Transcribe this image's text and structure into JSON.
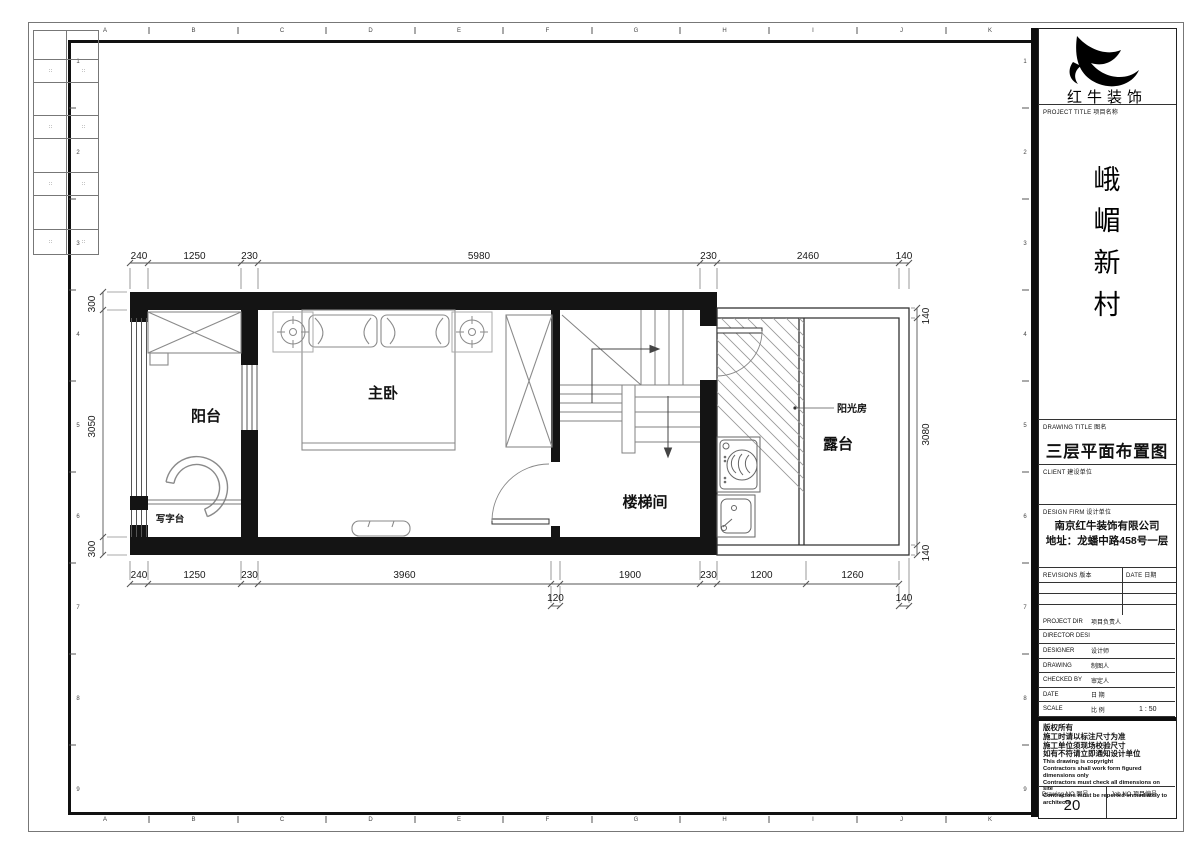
{
  "sheet": {
    "grid_letters": [
      "A",
      "B",
      "C",
      "D",
      "E",
      "F",
      "G",
      "H",
      "I",
      "J",
      "K"
    ],
    "grid_numbers": [
      "1",
      "2",
      "3",
      "4",
      "5",
      "6",
      "7",
      "8",
      "9"
    ],
    "fold_marks": [
      "∷",
      "∷",
      "∷",
      "∷",
      "∷",
      "∷",
      "∷",
      "∷"
    ]
  },
  "title_block": {
    "brand": "红牛装饰",
    "project_title_label": "PROJECT TITLE  项目名称",
    "project_name_chars": [
      "峨",
      "嵋",
      "新",
      "村"
    ],
    "drawing_title_label": "DRAWING TITLE  图名",
    "drawing_title": "三层平面布置图",
    "client_label": "CLIENT  建设单位",
    "design_firm_label": "DESIGN FIRM  设计单位",
    "design_firm_name": "南京红牛装饰有限公司",
    "design_firm_address": "地址：龙蟠中路458号一层",
    "revisions_label": "REVISIONS  版本",
    "date_label": "DATE  日期",
    "staff_rows": [
      {
        "en": "PROJECT DIR",
        "zh": "项目负责人",
        "value": ""
      },
      {
        "en": "DIRECTOR DESI",
        "zh": "",
        "value": ""
      },
      {
        "en": "DESIGNER",
        "zh": "设计师",
        "value": ""
      },
      {
        "en": "DRAWING",
        "zh": "制图人",
        "value": ""
      },
      {
        "en": "CHECKED BY",
        "zh": "审定人",
        "value": ""
      },
      {
        "en": "DATE",
        "zh": "日  期",
        "value": ""
      },
      {
        "en": "SCALE",
        "zh": "比  例",
        "value": "1 : 50"
      }
    ],
    "copyright_cn": [
      "版权所有",
      "施工时请以标注尺寸为准",
      "施工单位须现场校验尺寸",
      "如有不符请立即通知设计单位"
    ],
    "copyright_en": [
      "This drawing is copyright",
      "Contractors shall work form figured dimensions only",
      "Contractors must check all dimensions on site",
      "Contractors must be reported immediately to architects"
    ],
    "drawing_no_label": "Drawing NO  图号",
    "drawing_no": "20",
    "job_no_label": "Job NO  项目编号"
  },
  "plan": {
    "rooms": {
      "balcony": "阳台",
      "bedroom": "主卧",
      "stairwell": "楼梯间",
      "desk": "写字台",
      "sunroom": "阳光房",
      "terrace": "露台"
    },
    "dims": {
      "top": [
        "240",
        "1250",
        "230",
        "5980",
        "230",
        "2460",
        "140"
      ],
      "bottom1": [
        "240",
        "1250",
        "230",
        "3960",
        "1900",
        "230",
        "1200",
        "1260"
      ],
      "bottom2": [
        "120",
        "140"
      ],
      "left": [
        "300",
        "3050",
        "300"
      ],
      "right": [
        "140",
        "3080",
        "140"
      ]
    }
  }
}
